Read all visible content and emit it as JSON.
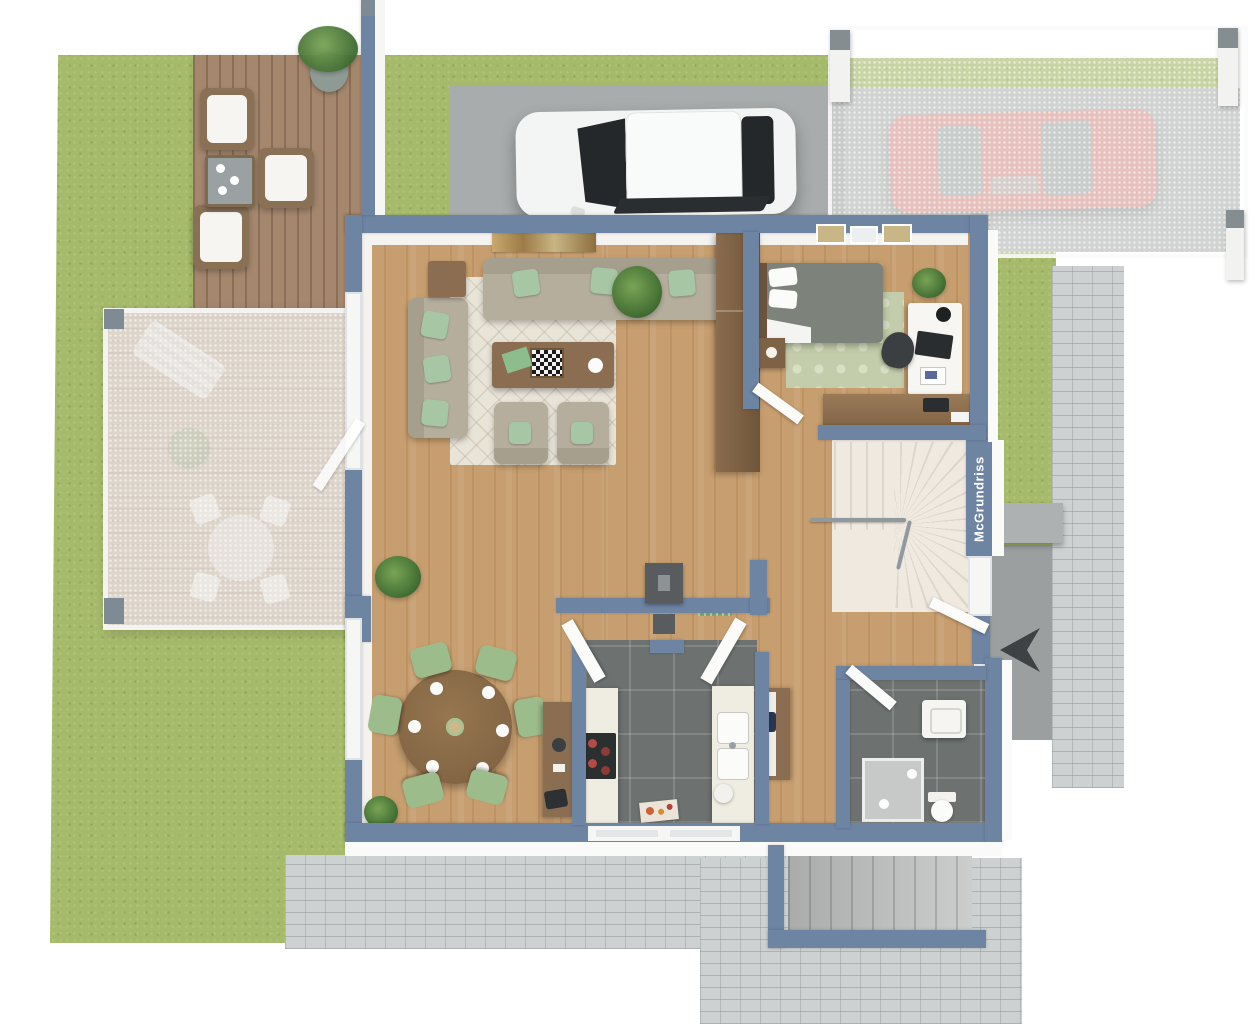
{
  "watermark": {
    "text": "McGrundriss"
  },
  "palette": {
    "wall": "#6e84a3",
    "grass": "#a6ba6b",
    "wood_floor": "#c79e6f",
    "deck_wood": "#a5876e",
    "dark_tile": "#6d7271",
    "concrete_paving": "#a8acac",
    "brick_paving": "#cdd1d2",
    "stair_tread": "#efe9e0",
    "sofa_beige": "#b5ae9d",
    "accent_pillow_green": "#a6c6a4",
    "dining_chair_green": "#9cbd8b",
    "furniture_wood": "#8b6e51",
    "white_car": "#f3f4f4",
    "red_car": "#db9a93",
    "bed_blanket_gray": "#7d827a",
    "kitchen_counter": "#efece1",
    "cooktop_black": "#2c2f30",
    "north_arrow": "#3e4245"
  },
  "icons": {
    "north_arrow": "left-pointing compass arrow"
  }
}
